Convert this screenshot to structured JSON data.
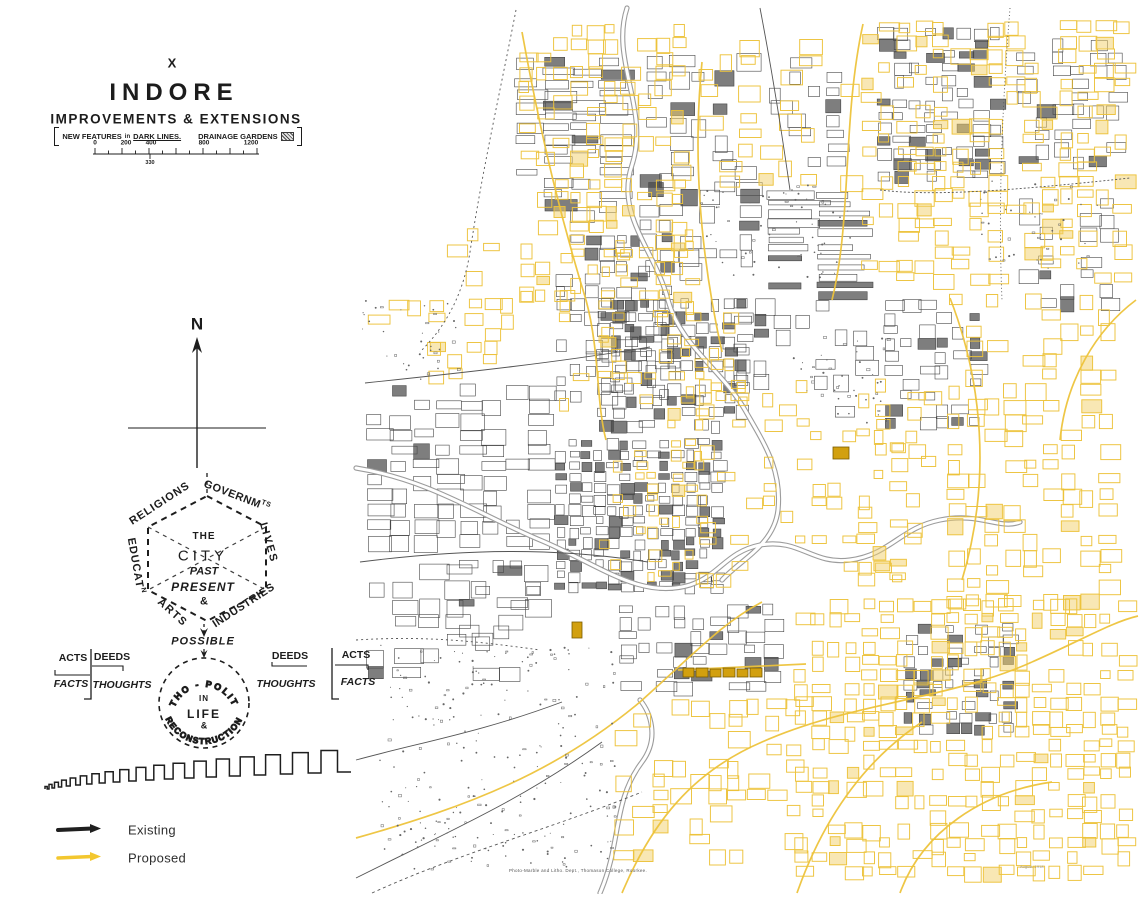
{
  "header": {
    "plate_no": "X",
    "title": "INDORE",
    "subtitle": "IMPROVEMENTS & EXTENSIONS",
    "note": {
      "part1": "NEW FEATURES",
      "part2": "in",
      "part3": "DARK LINES.",
      "part4": "DRAINAGE GARDENS"
    },
    "scale": {
      "ticks": [
        "0",
        "200",
        "400",
        "800",
        "1200"
      ],
      "sub_label": "330"
    }
  },
  "compass": {
    "label": "N"
  },
  "geddes_diagram": {
    "hex": {
      "top_left": "RELIGIONS",
      "top_right_main": "GOVERNM",
      "top_right_sup": "TS",
      "right": "LIVES",
      "left_main": "EDUCAT",
      "left_sup": "N",
      "bottom_left": "ARTS",
      "bottom_right": "INDUSTRIES"
    },
    "center": {
      "l1": "THE",
      "l2": "CITY",
      "l3": "PAST",
      "l4": "PRESENT",
      "l5": "&"
    },
    "possible": "POSSIBLE",
    "circle": {
      "top": "ETHO - POLITY",
      "m1": "IN",
      "m2": "LIFE",
      "m3": "&",
      "bottom": "RECONSTRUCTION"
    },
    "left_matrix": {
      "tl": "ACTS",
      "tr": "DEEDS",
      "bl": "FACTS",
      "br": "THOUGHTS"
    },
    "right_matrix": {
      "tl": "DEEDS",
      "tr": "ACTS",
      "bl": "THOUGHTS",
      "br": "FACTS"
    }
  },
  "legend": {
    "items": [
      {
        "label": "Existing",
        "color": "#1f1f1f"
      },
      {
        "label": "Proposed",
        "color": "#f3c72f"
      }
    ]
  },
  "captions": {
    "imprint": "Photo-Marble and Litho. Dept., Thomason College, Roorkee.",
    "edition": "August, 1918"
  },
  "map_figure": {
    "seed": 7,
    "ink": "#474747",
    "yellow": "#edc33b",
    "yellow_fill": "#f2d06a",
    "ochre": "#d2a00f",
    "ochre_edge": "#7a5c00",
    "river": "#9c9c9c",
    "regions_ink": [
      [
        516,
        58,
        125,
        170,
        26,
        9,
        0.7,
        0.22
      ],
      [
        556,
        235,
        132,
        172,
        13,
        11,
        0.65,
        0.18
      ],
      [
        648,
        55,
        118,
        150,
        20,
        14,
        0.5,
        0.1
      ],
      [
        768,
        192,
        105,
        112,
        48,
        7,
        0.8,
        0.3
      ],
      [
        878,
        28,
        132,
        162,
        14,
        10,
        0.6,
        0.22
      ],
      [
        1018,
        40,
        112,
        132,
        16,
        11,
        0.5,
        0.12
      ],
      [
        598,
        300,
        160,
        142,
        12,
        10,
        0.75,
        0.28
      ],
      [
        556,
        440,
        172,
        162,
        11,
        9,
        0.8,
        0.32
      ],
      [
        368,
        385,
        188,
        175,
        21,
        13,
        0.7,
        0.07
      ],
      [
        368,
        565,
        200,
        132,
        24,
        15,
        0.5,
        0.05
      ],
      [
        735,
        300,
        142,
        132,
        18,
        13,
        0.45,
        0.1
      ],
      [
        885,
        300,
        117,
        132,
        15,
        11,
        0.5,
        0.12
      ],
      [
        620,
        605,
        162,
        97,
        16,
        11,
        0.6,
        0.14
      ],
      [
        905,
        625,
        112,
        112,
        12,
        9,
        0.55,
        0.35
      ],
      [
        770,
        45,
        92,
        132,
        17,
        12,
        0.4,
        0.1
      ],
      [
        1020,
        200,
        112,
        112,
        18,
        12,
        0.4,
        0.1
      ],
      [
        640,
        160,
        120,
        130,
        18,
        13,
        0.45,
        0.12
      ],
      [
        460,
        560,
        100,
        100,
        15,
        11,
        0.4,
        0.08
      ]
    ],
    "regions_yellow": [
      [
        520,
        25,
        185,
        280,
        15,
        12,
        0.5,
        0.1
      ],
      [
        862,
        22,
        272,
        268,
        16,
        12,
        0.55,
        0.1
      ],
      [
        948,
        295,
        188,
        318,
        17,
        13,
        0.5,
        0.08
      ],
      [
        795,
        600,
        342,
        286,
        15,
        12,
        0.6,
        0.1
      ],
      [
        615,
        700,
        192,
        172,
        17,
        13,
        0.38,
        0.06
      ],
      [
        560,
        230,
        142,
        190,
        12,
        10,
        0.22,
        0.04
      ],
      [
        700,
        380,
        242,
        212,
        14,
        11,
        0.26,
        0.04
      ],
      [
        430,
        230,
        112,
        142,
        16,
        12,
        0.28,
        0.05
      ],
      [
        368,
        300,
        122,
        86,
        18,
        12,
        0.22,
        0.04
      ],
      [
        600,
        440,
        112,
        152,
        10,
        9,
        0.28,
        0.05
      ],
      [
        858,
        430,
        94,
        162,
        14,
        11,
        0.32,
        0.06
      ],
      [
        700,
        40,
        170,
        150,
        18,
        13,
        0.3,
        0.05
      ],
      [
        598,
        300,
        160,
        142,
        12,
        10,
        0.22,
        0.04
      ]
    ],
    "scatters": [
      [
        380,
        645,
        235,
        225,
        240
      ],
      [
        700,
        185,
        155,
        95,
        60
      ],
      [
        793,
        335,
        100,
        88,
        45
      ],
      [
        362,
        300,
        100,
        80,
        36
      ],
      [
        980,
        180,
        120,
        90,
        40
      ]
    ],
    "roads_yellow": [
      "M356,838 C470,806 556,772 640,702 C700,648 724,622 762,602",
      "M622,893 C652,822 692,772 762,742 C852,702 948,700 1032,662",
      "M797,893 C822,822 862,762 922,722",
      "M863,24 C842,120 852,220 832,300",
      "M950,298 C982,380 992,480 962,580",
      "M522,32 C542,142 562,222 586,300",
      "M702,62 C692,162 702,262 722,352",
      "M1032,662 C1082,640 1112,622 1138,616",
      "M900,893 C922,832 982,792 1052,782",
      "M678,670 L806,664",
      "M586,300 C600,352 596,402 606,440",
      "M1136,300 C1096,330 1066,380 1060,440"
    ],
    "roads_ink": [
      {
        "d": "M516,10 C500,92 482,172 470,252 C462,302 440,332 420,352",
        "dash": "2 3"
      },
      {
        "d": "M365,383 C470,372 560,362 650,347",
        "dash": ""
      },
      {
        "d": "M360,562 C470,548 560,548 648,562",
        "dash": ""
      },
      {
        "d": "M356,878 C452,830 522,800 602,742",
        "dash": ""
      },
      {
        "d": "M372,893 C462,852 542,832 642,792",
        "dash": "3 3"
      },
      {
        "d": "M356,760 C422,742 482,732 562,702",
        "dash": ""
      },
      {
        "d": "M1010,8 C1002,108 998,208 1002,300",
        "dash": "1 2.5"
      },
      {
        "d": "M356,640 C420,636 470,640 540,650",
        "dash": "2 3"
      },
      {
        "d": "M760,8 C770,60 780,120 790,190",
        "dash": ""
      },
      {
        "d": "M880,190 C930,196 1000,192 1130,178",
        "dash": "2 2"
      }
    ],
    "rivers": [
      "M627,8 C610,60 650,110 632,165 C615,215 655,250 668,300 C680,345 722,370 745,410 C765,445 782,470 778,510 C774,545 740,560 722,580",
      "M356,468 C430,480 480,515 540,540 C600,565 640,600 690,585 C720,575 726,552 760,545 C800,538 812,565 850,560 C890,555 900,528 940,520 C980,512 1000,530 1020,522",
      "M600,893 C622,842 612,802 642,762 C660,738 650,712 640,700"
    ],
    "ochre_blocks": [
      [
        683,
        668,
        11,
        9
      ],
      [
        696,
        668,
        12,
        9
      ],
      [
        710,
        669,
        11,
        8
      ],
      [
        723,
        668,
        12,
        9
      ],
      [
        737,
        669,
        11,
        8
      ],
      [
        750,
        668,
        12,
        9
      ],
      [
        833,
        447,
        16,
        12
      ],
      [
        572,
        622,
        10,
        16
      ]
    ]
  }
}
